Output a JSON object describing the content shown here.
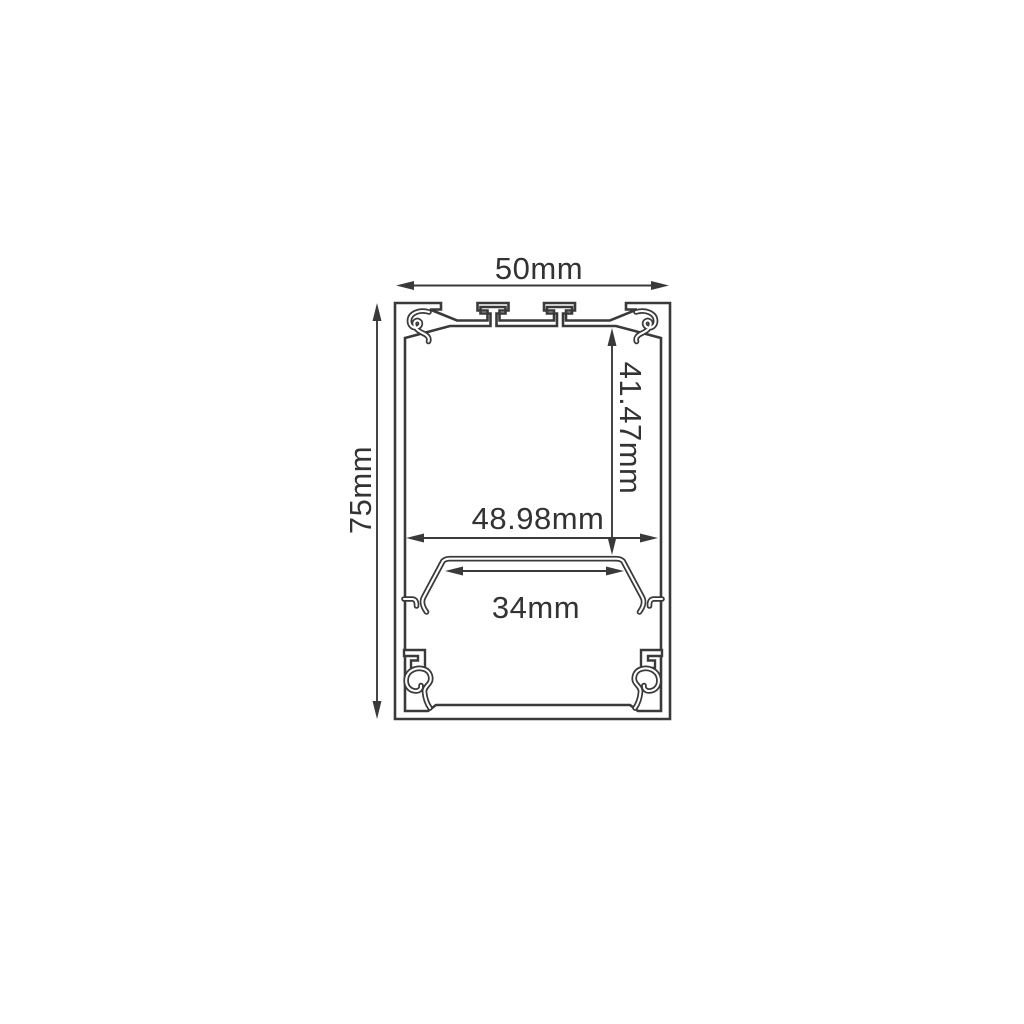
{
  "drawing": {
    "background_color": "#ffffff",
    "line_color": "#3a3a3a",
    "text_color": "#333333",
    "type": "profile-cross-section",
    "dimensions": [
      {
        "id": "overall-width",
        "label": "50mm",
        "value": 50,
        "unit": "mm",
        "orientation": "horizontal",
        "location": "top"
      },
      {
        "id": "overall-height",
        "label": "75mm",
        "value": 75,
        "unit": "mm",
        "orientation": "vertical",
        "location": "left"
      },
      {
        "id": "cavity-depth",
        "label": "41.47mm",
        "value": 41.47,
        "unit": "mm",
        "orientation": "vertical",
        "location": "inside-upper-cavity"
      },
      {
        "id": "cavity-width",
        "label": "48.98mm",
        "value": 48.98,
        "unit": "mm",
        "orientation": "horizontal",
        "location": "inside-upper-cavity"
      },
      {
        "id": "shelf-width",
        "label": "34mm",
        "value": 34,
        "unit": "mm",
        "orientation": "horizontal",
        "location": "below-shelf"
      }
    ]
  }
}
